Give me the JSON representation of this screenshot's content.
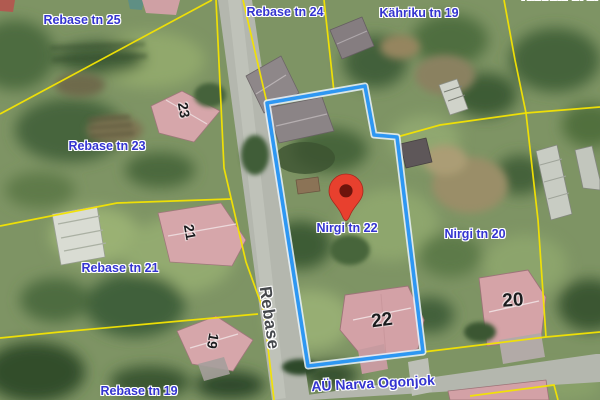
{
  "map": {
    "selected_address": "Nirgi tn 22",
    "labels": {
      "rebase25": "Rebase tn 25",
      "rebase24": "Rebase tn 24",
      "kahriku19": "Kähriku tn 19",
      "kahriku17_partial": "Kähriku tn 17",
      "rebase23": "Rebase tn 23",
      "rebase21": "Rebase tn 21",
      "rebase19": "Rebase tn 19",
      "nirgi22": "Nirgi tn 22",
      "nirgi20": "Nirgi tn 20"
    },
    "streets": {
      "rebase": "Rebase",
      "ogonjok": "AÜ Narva Ogonjok"
    },
    "house_numbers": {
      "h23": "23",
      "h21": "21",
      "h19": "19",
      "h22": "22",
      "h20": "20"
    },
    "colors": {
      "cadastral_line": "#f2e204",
      "selected_parcel_outline": "#2e97f2",
      "address_label": "#3434d0",
      "pin": "#e8402e",
      "road": "#b4b7ae"
    }
  }
}
